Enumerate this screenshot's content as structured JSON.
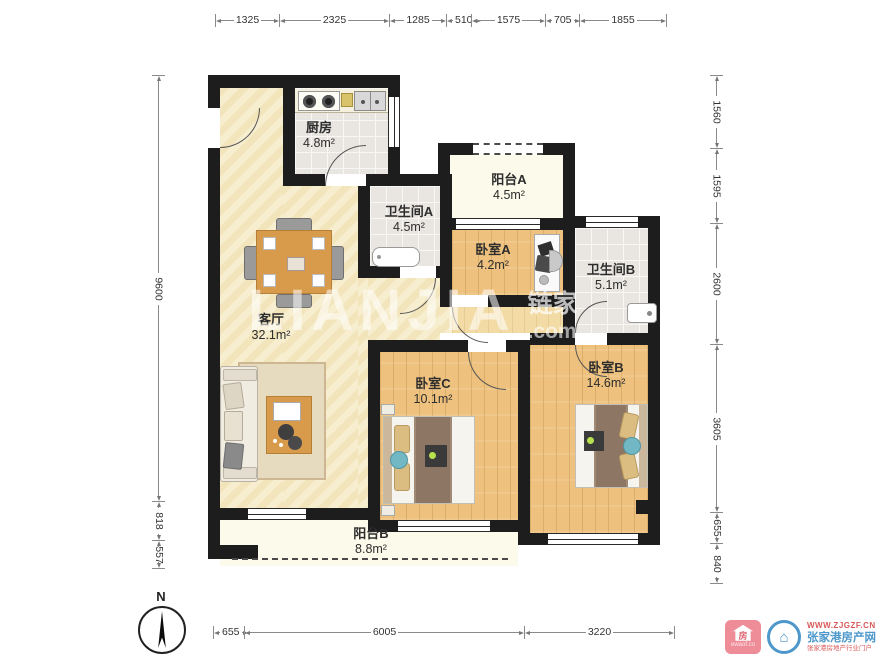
{
  "plan": {
    "rooms": [
      {
        "id": "kitchen",
        "name": "厨房",
        "area": "4.8m²"
      },
      {
        "id": "bath_a",
        "name": "卫生间A",
        "area": "4.5m²"
      },
      {
        "id": "balcony_a",
        "name": "阳台A",
        "area": "4.5m²"
      },
      {
        "id": "bedroom_a",
        "name": "卧室A",
        "area": "4.2m²"
      },
      {
        "id": "bath_b",
        "name": "卫生间B",
        "area": "5.1m²"
      },
      {
        "id": "living",
        "name": "客厅",
        "area": "32.1m²"
      },
      {
        "id": "bedroom_c",
        "name": "卧室C",
        "area": "10.1m²"
      },
      {
        "id": "bedroom_b",
        "name": "卧室B",
        "area": "14.6m²"
      },
      {
        "id": "balcony_b",
        "name": "阳台B",
        "area": "8.8m²"
      }
    ],
    "compass": {
      "label": "N"
    },
    "colors": {
      "wall": "#1d1d1d",
      "wood": "#eec27e",
      "tile": "#e9e6e1",
      "living": "#f6ebc6",
      "balcony": "#fcfaea"
    }
  },
  "dimensions": {
    "top": [
      "1325",
      "2325",
      "1285",
      "510",
      "1575",
      "705",
      "1855"
    ],
    "left": [
      "9600",
      "818",
      "557"
    ],
    "right": [
      "1560",
      "1595",
      "2600",
      "3605",
      "655",
      "840"
    ],
    "bottom": [
      "655",
      "6005",
      "3220"
    ]
  },
  "watermark": {
    "brand": "LIANJIA",
    "brand_cn": "链家",
    "suffix": ".com"
  },
  "footer_logos": {
    "left_logo_char": "房",
    "left_logo_sub": "ewaof.co",
    "site_url": "WWW.ZJGZF.CN",
    "site_name": "张家港房产网",
    "site_tagline": "张家港房地产行业门户"
  }
}
